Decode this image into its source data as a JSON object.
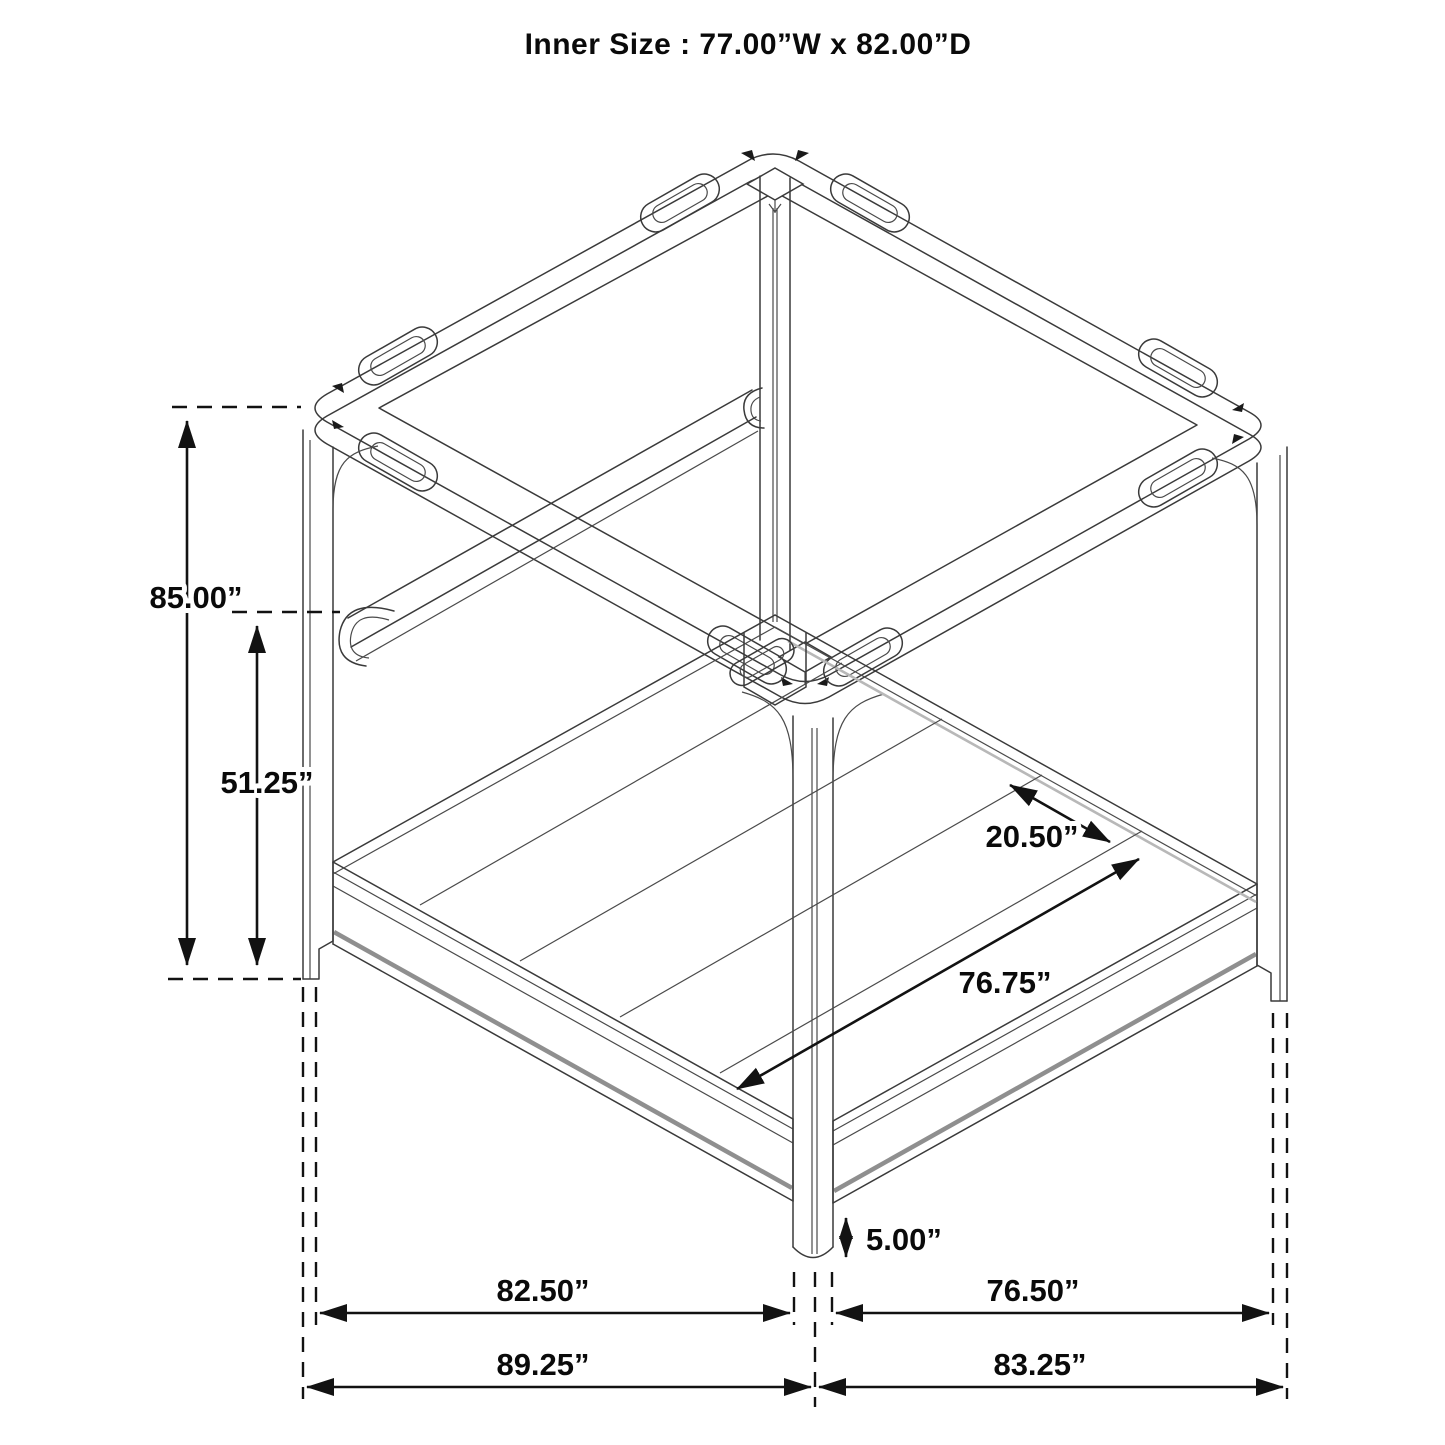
{
  "title": "Inner Size : 77.00”W x 82.00”D",
  "drawing": {
    "subject": "canopy bed frame isometric dimension diagram"
  },
  "dimensions": {
    "overall_height": "85.00”",
    "headboard_height": "51.25”",
    "rear_rail_inset": "20.50”",
    "slat_span": "76.75”",
    "floor_clearance": "5.00”",
    "side_inner_depth": "82.50”",
    "side_inner_width": "76.50”",
    "overall_depth": "89.25”",
    "overall_width": "83.25”"
  }
}
